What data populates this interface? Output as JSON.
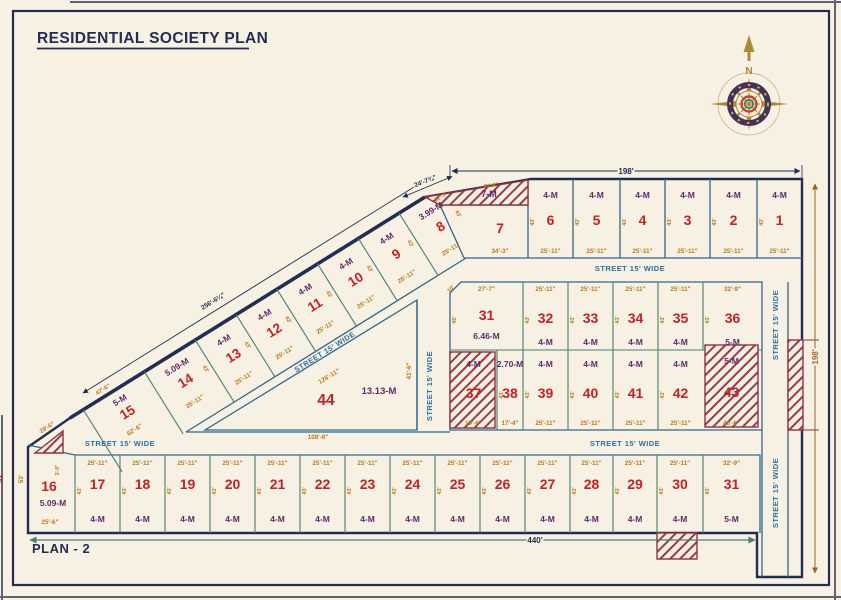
{
  "title": "RESIDENTIAL SOCIETY PLAN",
  "plan_label": "PLAN - 2",
  "compass": {
    "north": "N"
  },
  "street_label": "STREET 15' WIDE",
  "reserved_strip": {
    "area": "7-M"
  },
  "dims": {
    "top_width": "198'",
    "right_height": "198'",
    "bottom_width": "440'",
    "diagonal": "256'-6¼\"",
    "corner_top": "24'-7¾\"",
    "strip_top": "43'-9\"",
    "strip_left": "12'-3\"",
    "above_15": "47'-6\"",
    "left_corner": "29'-6\"",
    "left_edge": "53'",
    "p16_top": "3'-9\"",
    "chamfer": "10'"
  },
  "colors": {
    "paper": "#f6f1e2",
    "navy": "#232c52",
    "plot_number_red": "#c42127",
    "area_purple": "#5f2a68",
    "dim_orange": "#b97a1d",
    "street_blue": "#2f6fa0",
    "divider_green": "#4b7f6e",
    "hatch_maroon": "#8e3344",
    "compass_gold": "#ab8a35"
  },
  "plots": [
    {
      "id": "p1",
      "no": "1",
      "area": "4-M",
      "width": "25'-11\"",
      "side": "43'"
    },
    {
      "id": "p2",
      "no": "2",
      "area": "4-M",
      "width": "25'-11\"",
      "side": "43'"
    },
    {
      "id": "p3",
      "no": "3",
      "area": "4-M",
      "width": "25'-11\"",
      "side": "43'"
    },
    {
      "id": "p4",
      "no": "4",
      "area": "4-M",
      "width": "25'-11\"",
      "side": "43'"
    },
    {
      "id": "p5",
      "no": "5",
      "area": "4-M",
      "width": "25'-11\"",
      "side": "43'"
    },
    {
      "id": "p6",
      "no": "6",
      "area": "4-M",
      "width": "25'-11\"",
      "side": "43'"
    },
    {
      "id": "p7",
      "no": "7",
      "area": "",
      "width": "34'-3\"",
      "side": ""
    },
    {
      "id": "p8",
      "no": "8",
      "area": "3.99-M",
      "width": "25'-11\"",
      "side": "43'"
    },
    {
      "id": "p9",
      "no": "9",
      "area": "4-M",
      "width": "25'-11\"",
      "side": "43'"
    },
    {
      "id": "p10",
      "no": "10",
      "area": "4-M",
      "width": "25'-11\"",
      "side": "43'"
    },
    {
      "id": "p11",
      "no": "11",
      "area": "4-M",
      "width": "25'-11\"",
      "side": "43'"
    },
    {
      "id": "p12",
      "no": "12",
      "area": "4-M",
      "width": "25'-11\"",
      "side": "43'"
    },
    {
      "id": "p13",
      "no": "13",
      "area": "4-M",
      "width": "25'-11\"",
      "side": "43'"
    },
    {
      "id": "p14",
      "no": "14",
      "area": "5.09-M",
      "width": "25'-11\"",
      "side": "43'"
    },
    {
      "id": "p15",
      "no": "15",
      "area": "5-M",
      "width": "62'-6\"",
      "side": ""
    },
    {
      "id": "p16",
      "no": "16",
      "area": "5.09-M",
      "width": "25'-6\"",
      "side": "53'"
    },
    {
      "id": "p17",
      "no": "17",
      "area": "4-M",
      "width": "25'-11\"",
      "side": "43'"
    },
    {
      "id": "p18",
      "no": "18",
      "area": "4-M",
      "width": "25'-11\"",
      "side": "43'"
    },
    {
      "id": "p19",
      "no": "19",
      "area": "4-M",
      "width": "25'-11\"",
      "side": "43'"
    },
    {
      "id": "p20",
      "no": "20",
      "area": "4-M",
      "width": "25'-11\"",
      "side": "43'"
    },
    {
      "id": "p21",
      "no": "21",
      "area": "4-M",
      "width": "25'-11\"",
      "side": "43'"
    },
    {
      "id": "p22",
      "no": "22",
      "area": "4-M",
      "width": "25'-11\"",
      "side": "43'"
    },
    {
      "id": "p23",
      "no": "23",
      "area": "4-M",
      "width": "25'-11\"",
      "side": "43'"
    },
    {
      "id": "p24",
      "no": "24",
      "area": "4-M",
      "width": "25'-11\"",
      "side": "43'"
    },
    {
      "id": "p25",
      "no": "25",
      "area": "4-M",
      "width": "25'-11\"",
      "side": "43'"
    },
    {
      "id": "p26",
      "no": "26",
      "area": "4-M",
      "width": "25'-11\"",
      "side": "43'"
    },
    {
      "id": "p27",
      "no": "27",
      "area": "4-M",
      "width": "25'-11\"",
      "side": "43'"
    },
    {
      "id": "p28",
      "no": "28",
      "area": "4-M",
      "width": "25'-11\"",
      "side": "43'"
    },
    {
      "id": "p29",
      "no": "29",
      "area": "4-M",
      "width": "25'-11\"",
      "side": "43'"
    },
    {
      "id": "p30",
      "no": "30",
      "area": "4-M",
      "width": "25'-11\"",
      "side": "43'"
    },
    {
      "id": "p31b",
      "no": "31",
      "area": "5-M",
      "width": "32'-9\"",
      "side": "43'"
    },
    {
      "id": "p31",
      "no": "31",
      "area": "6.46-M",
      "width": "27'-7\"",
      "side": "45'"
    },
    {
      "id": "p32",
      "no": "32",
      "area": "4-M",
      "width": "25'-11\"",
      "side": "43'"
    },
    {
      "id": "p33",
      "no": "33",
      "area": "4-M",
      "width": "25'-11\"",
      "side": "43'"
    },
    {
      "id": "p34",
      "no": "34",
      "area": "4-M",
      "width": "25'-11\"",
      "side": "43'"
    },
    {
      "id": "p35",
      "no": "35",
      "area": "4-M",
      "width": "25'-11\"",
      "side": "43'"
    },
    {
      "id": "p36",
      "no": "36",
      "area": "5-M",
      "width": "32'-9\"",
      "side": "43'"
    },
    {
      "id": "p37",
      "no": "37",
      "area": "4-M",
      "width": "19'-6\"",
      "side": ""
    },
    {
      "id": "p38",
      "no": "38",
      "area": "2.70-M",
      "width": "17'-4\"",
      "side": "43'"
    },
    {
      "id": "p39",
      "no": "39",
      "area": "4-M",
      "width": "25'-11\"",
      "side": "43'"
    },
    {
      "id": "p40",
      "no": "40",
      "area": "4-M",
      "width": "25'-11\"",
      "side": "43'"
    },
    {
      "id": "p41",
      "no": "41",
      "area": "4-M",
      "width": "25'-11\"",
      "side": "43'"
    },
    {
      "id": "p42",
      "no": "42",
      "area": "4-M",
      "width": "25'-11\"",
      "side": "43'"
    },
    {
      "id": "p43",
      "no": "43",
      "area": "5-M",
      "width": "40'-6\"",
      "side": ""
    },
    {
      "id": "p44",
      "no": "44",
      "area": "13.13-M",
      "width": "108'-8\"",
      "side": "41'-6\"",
      "hyp": "126'-11\""
    }
  ]
}
